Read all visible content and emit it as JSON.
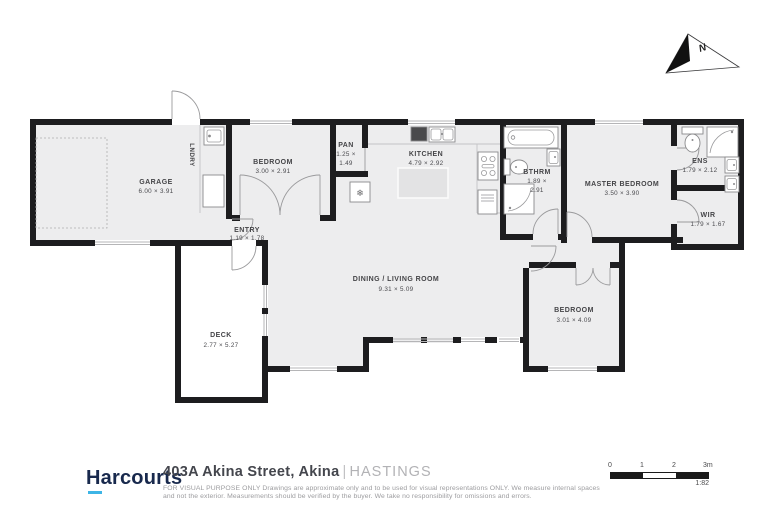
{
  "floorplan": {
    "rooms": {
      "garage": {
        "name": "GARAGE",
        "dims": "6.00 × 3.91"
      },
      "laundry": {
        "name": "LNDRY"
      },
      "bedroom1": {
        "name": "BEDROOM",
        "dims": "3.00 × 2.91"
      },
      "pantry": {
        "name": "PAN",
        "dims_line1": "1.25 ×",
        "dims_line2": "1.49"
      },
      "kitchen": {
        "name": "KITCHEN",
        "dims": "4.79 × 2.92"
      },
      "bathroom": {
        "name": "BTHRM",
        "dims_line1": "1.89 ×",
        "dims_line2": "2.91"
      },
      "master_bedroom": {
        "name": "MASTER BEDROOM",
        "dims": "3.50 × 3.90"
      },
      "ensuite": {
        "name": "ENS",
        "dims": "1.79 × 2.12"
      },
      "wardrobe": {
        "name": "WIR",
        "dims": "1.79 × 1.67"
      },
      "entry": {
        "name": "ENTRY",
        "dims": "1.19 × 1.78"
      },
      "living": {
        "name": "DINING / LIVING ROOM",
        "dims": "9.31 × 5.09"
      },
      "bedroom2": {
        "name": "BEDROOM",
        "dims": "3.01 × 4.09"
      },
      "deck": {
        "name": "DECK",
        "dims": "2.77 × 5.27"
      }
    },
    "icons": {
      "heat_pump": "❄"
    },
    "compass": {
      "label": "N"
    }
  },
  "footer": {
    "brand": "Harcourts",
    "address": "403A Akina Street, Akina",
    "separator": "|",
    "locality": "HASTINGS",
    "disclaimer_lines": [
      "FOR VISUAL PURPOSE ONLY Drawings are approximate only and to be used for visual representations ONLY. We measure internal spaces",
      "and not the exterior. Measurements should be verified by the buyer. We take no responsibility for omissions and errors."
    ]
  },
  "scale_bar": {
    "ticks": [
      "0",
      "1",
      "2",
      "3m"
    ],
    "ratio": "1:82"
  },
  "colors": {
    "wall": "#1d1d1f",
    "floor": "#ededee",
    "accent_underline": "#3db5e6",
    "brand_navy": "#18294d"
  }
}
